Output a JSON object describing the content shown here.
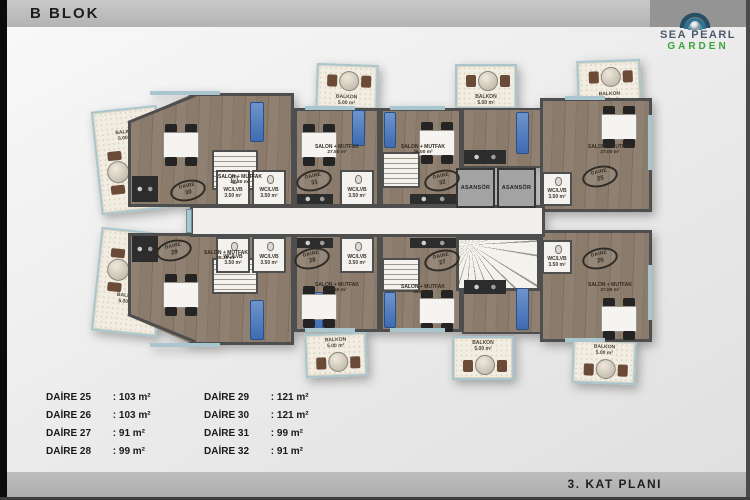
{
  "header": {
    "title": "B BLOK"
  },
  "logo": {
    "title": "SEA PEARL",
    "subtitle": "GARDEN"
  },
  "footer": {
    "title": "3. KAT PLANI"
  },
  "legend": {
    "items": [
      {
        "name": "DAİRE 25",
        "value": ": 103 m²"
      },
      {
        "name": "DAİRE 26",
        "value": ": 103 m²"
      },
      {
        "name": "DAİRE 27",
        "value": ": 91 m²"
      },
      {
        "name": "DAİRE 28",
        "value": ": 99 m²"
      },
      {
        "name": "DAİRE 29",
        "value": ": 121 m²"
      },
      {
        "name": "DAİRE 30",
        "value": ": 121 m²"
      },
      {
        "name": "DAİRE 31",
        "value": ": 99 m²"
      },
      {
        "name": "DAİRE 32",
        "value": ": 91 m²"
      }
    ]
  },
  "plan": {
    "daire_label": "DAİRE",
    "salon_label": "SALON + MUTFAK",
    "wc_label": "WC/LVB",
    "wc_area": "3.50 m²",
    "balcony_label": "BALKON",
    "balcony_area": "5.00 m²",
    "elevator_label": "ASANSÖR",
    "apartments": [
      {
        "num": "30",
        "salon_area": "28.30 m²"
      },
      {
        "num": "31",
        "salon_area": "27.50 m²"
      },
      {
        "num": "32",
        "salon_area": "26.00 m²"
      },
      {
        "num": "25",
        "salon_area": "27.00 m²"
      },
      {
        "num": "29",
        "salon_area": "28.30 m²"
      },
      {
        "num": "28",
        "salon_area": "27.50 m²"
      },
      {
        "num": "27",
        "salon_area": "26.00 m²"
      },
      {
        "num": "26",
        "salon_area": "27.00 m²"
      }
    ],
    "colors": {
      "wall": "#4e4e4e",
      "wood": "#8b7c6c",
      "balcony": "#f2ede2",
      "glass": "#a9c5cd",
      "blue_furniture": "#3e6cb2"
    }
  }
}
